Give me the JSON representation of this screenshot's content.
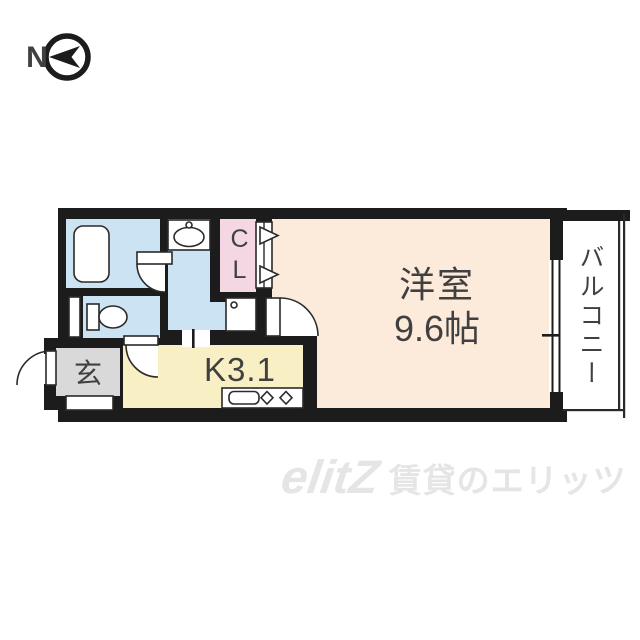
{
  "compass": {
    "north_label": "N"
  },
  "floor_plan": {
    "main_room": {
      "name": "洋室",
      "size": "9.6帖"
    },
    "kitchen": {
      "label": "K3.1"
    },
    "entrance": {
      "label": "玄"
    },
    "closet": {
      "label": "CL"
    },
    "balcony": {
      "label": "バルコニー"
    }
  },
  "watermark": {
    "logo": "elitZ",
    "text": "賃貸のエリッツ"
  },
  "colors": {
    "wall": "#1c1c1c",
    "line": "#2a2a2a",
    "wet-blue": "#cbe3f2",
    "closet-pink": "#f4d7e3",
    "room-peach": "#fceadb",
    "kitchen-yellow": "#f9efc4",
    "entrance-gray": "#d9d9da",
    "text-dark": "#404040",
    "watermark-gray": "#e5e5e5"
  }
}
